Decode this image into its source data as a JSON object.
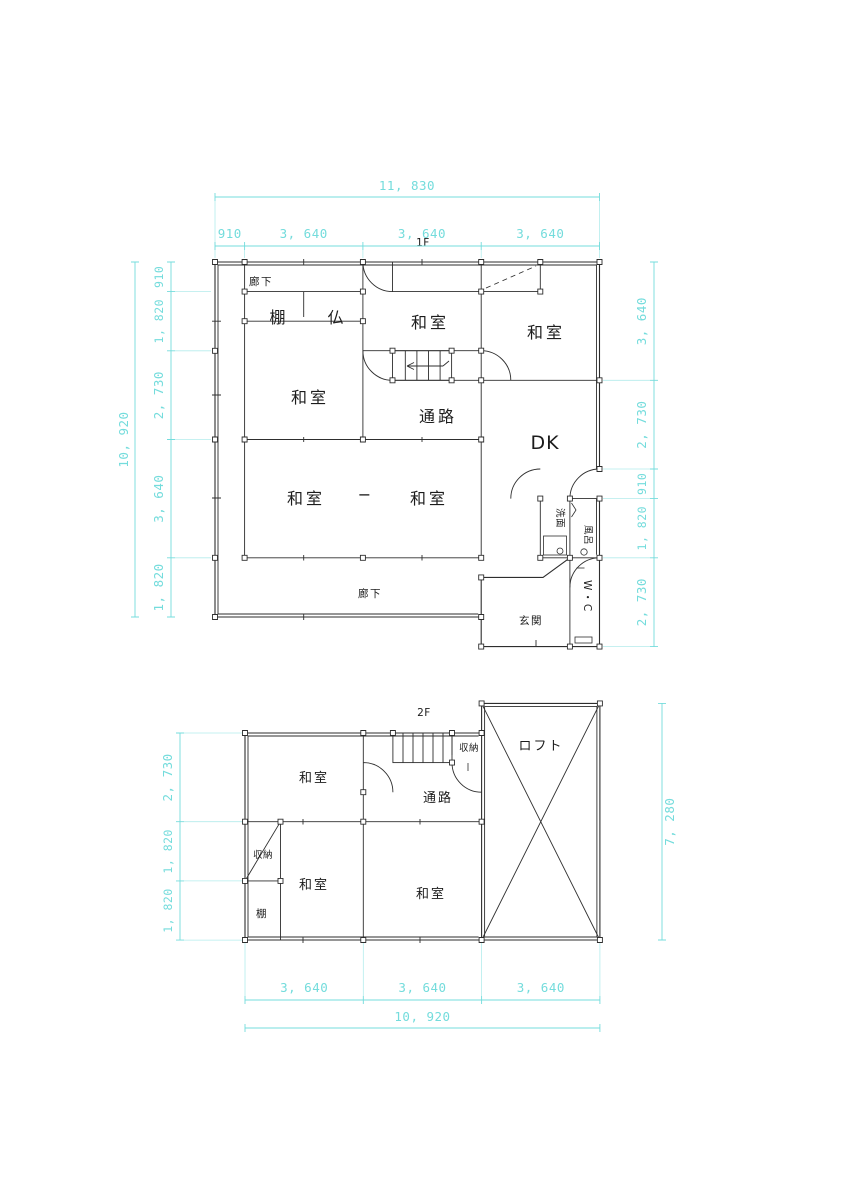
{
  "palette": {
    "dim_color": "#74dcdc",
    "wall_color": "#2e2e2e",
    "background": "#ffffff"
  },
  "f1": {
    "floor_label": "1F",
    "rooms": {
      "rouka_top": "廊下",
      "tana": "棚",
      "butsu": "仏",
      "washitsu_top_center": "和室",
      "washitsu_top_right": "和室",
      "washitsu_left": "和室",
      "tsuro": "通路",
      "dk": "DK",
      "washitsu_bottom_left": "和室",
      "partition_dash": "−",
      "washitsu_bottom_right": "和室",
      "rouka_bottom": "廊下",
      "senmen": "洗面",
      "furo": "風呂",
      "genkan": "玄関",
      "wc": "W・C"
    },
    "dims": {
      "top_total": "11, 830",
      "top_segments": [
        "910",
        "3, 640",
        "3, 640",
        "3, 640"
      ],
      "left_total": "10, 920",
      "left_segments": [
        "910",
        "1, 820",
        "2, 730",
        "3, 640",
        "1, 820"
      ],
      "right_segments": [
        "3, 640",
        "2, 730",
        "910",
        "1, 820",
        "2, 730"
      ]
    }
  },
  "f2": {
    "floor_label": "2F",
    "rooms": {
      "washitsu_top": "和室",
      "shuno_top": "収納",
      "tsuro": "通路",
      "loft": "ロフト",
      "shuno_left": "収納",
      "washitsu_bottom_left": "和室",
      "washitsu_bottom_right": "和室",
      "tana": "棚"
    },
    "dims": {
      "left_segments": [
        "2, 730",
        "1, 820",
        "1, 820"
      ],
      "right_total": "7, 280",
      "bottom_segments": [
        "3, 640",
        "3, 640",
        "3, 640"
      ],
      "bottom_total": "10, 920"
    }
  }
}
